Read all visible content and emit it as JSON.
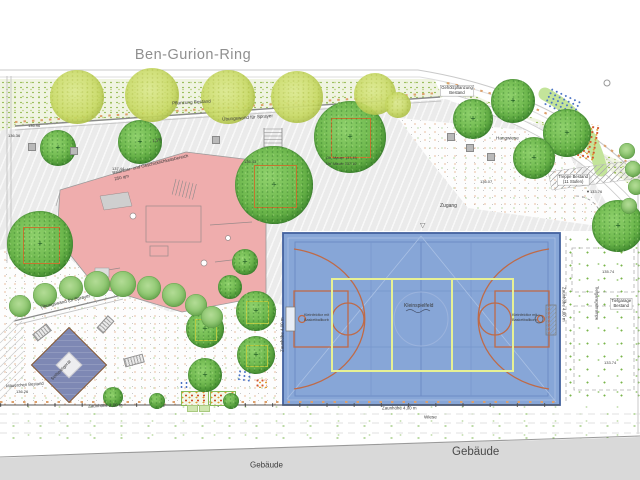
{
  "street_name": "Ben-Gurion-Ring",
  "building_label": "Gebäude",
  "colors": {
    "court_blue": "#87a6d7",
    "court_line_orange": "#bf6a47",
    "court_line_yellow": "#e7f193",
    "playground_pink": "#efadad",
    "equip_blue": "#7e88b4",
    "tree_green": "#67b247",
    "tree_light_green": "#c8da63",
    "building_gray": "#d9d9d9"
  },
  "labels": [
    {
      "t": "Pflanzung Bestand",
      "x": 172,
      "y": 101,
      "r": -3,
      "f": 4.6,
      "n": "planting-existing"
    },
    {
      "t": "Übungswand für Sprayer",
      "x": 222,
      "y": 117,
      "r": -4,
      "f": 4.6,
      "n": "sprayer-wall"
    },
    {
      "t": "Übungswand für Sprayer",
      "x": 40,
      "y": 305,
      "r": -13,
      "f": 4.6,
      "n": "sprayer-wall-2"
    },
    {
      "t": "Zugang",
      "x": 440,
      "y": 203,
      "r": 0,
      "f": 5,
      "n": "entrance"
    },
    {
      "t": "Hangwiese",
      "x": 496,
      "y": 136,
      "r": 0,
      "f": 4.6,
      "n": "slope-meadow"
    },
    {
      "t": "Wiese",
      "x": 424,
      "y": 415,
      "r": 0,
      "f": 4.6,
      "n": "meadow"
    },
    {
      "t": "Gebäude",
      "x": 250,
      "y": 461,
      "r": 0,
      "f": 8,
      "n": "building-small"
    },
    {
      "t": "Zaunhöhe 2,00 m",
      "x": 88,
      "y": 404,
      "r": -2,
      "f": 4.4,
      "n": "fence-2m"
    },
    {
      "t": "Zaunhöhe 4,00 m",
      "x": 382,
      "y": 406,
      "r": 0,
      "f": 4.4,
      "n": "fence-4m-bottom"
    },
    {
      "t": "Zaunhöhe 4,00 m",
      "x": 566,
      "y": 287,
      "r": 90,
      "f": 4.4,
      "n": "fence-4m-right"
    },
    {
      "t": "Zaunhöhe 4,00 m",
      "x": 280,
      "y": 352,
      "r": -90,
      "f": 4.4,
      "n": "fence-4m-left"
    },
    {
      "t": "Mäuerchen Bestand",
      "x": 6,
      "y": 384,
      "r": -4,
      "f": 4.2,
      "n": "wall-existing"
    },
    {
      "t": "Tiefgaragenrampe",
      "x": 599,
      "y": 286,
      "r": 90,
      "f": 4.2,
      "n": "garage-ramp"
    },
    {
      "t": "Seilspielgerät",
      "x": 50,
      "y": 378,
      "r": -45,
      "f": 4.4,
      "n": "rope-play"
    },
    {
      "t": "Kleinspielfeld",
      "x": 404,
      "y": 303,
      "r": 0,
      "f": 5,
      "n": "court-center"
    },
    {
      "t": "Kleinfeldtor mit",
      "x": 304,
      "y": 313,
      "r": 0,
      "f": 3.8,
      "n": "goal-left-1"
    },
    {
      "t": "Basketballkorb",
      "x": 304,
      "y": 318,
      "r": 0,
      "f": 3.8,
      "n": "goal-left-2"
    },
    {
      "t": "Kleinfeldtor mit",
      "x": 512,
      "y": 313,
      "r": 0,
      "f": 3.8,
      "n": "goal-right-1"
    },
    {
      "t": "Basketballkorb",
      "x": 512,
      "y": 318,
      "r": 0,
      "f": 3.8,
      "n": "goal-right-2"
    },
    {
      "t": "Balancier- und Geschicklichkeitsbereich",
      "x": 112,
      "y": 171,
      "r": -13,
      "f": 4.4,
      "n": "playground-title"
    },
    {
      "t": "250 qm",
      "x": 114,
      "y": 177,
      "r": -13,
      "f": 4.4,
      "n": "playground-area"
    },
    {
      "t": "Ob. Mauer 137.45",
      "x": 326,
      "y": 156,
      "r": 0,
      "f": 3.8,
      "n": "wall-top-elev"
    },
    {
      "t": "Un. Mauer 137.10",
      "x": 326,
      "y": 162,
      "r": 0,
      "f": 3.8,
      "n": "wall-bottom-elev"
    },
    {
      "t": "1,5%",
      "x": 152,
      "y": 139,
      "r": -10,
      "f": 4.2,
      "n": "slope-percent"
    },
    {
      "t": "136.96",
      "x": 28,
      "y": 124,
      "r": 0,
      "f": 4,
      "n": "elev"
    },
    {
      "t": "137.44",
      "x": 112,
      "y": 167,
      "r": 0,
      "f": 4,
      "n": "elev"
    },
    {
      "t": "136.43",
      "x": 244,
      "y": 160,
      "r": 0,
      "f": 4,
      "n": "elev"
    },
    {
      "t": "136.36",
      "x": 8,
      "y": 134,
      "r": 0,
      "f": 4,
      "n": "elev"
    },
    {
      "t": "136.26",
      "x": 16,
      "y": 390,
      "r": 0,
      "f": 4,
      "n": "elev"
    },
    {
      "t": "136.07",
      "x": 480,
      "y": 180,
      "r": 0,
      "f": 4,
      "n": "elev"
    },
    {
      "t": "135.74",
      "x": 602,
      "y": 270,
      "r": 0,
      "f": 4,
      "n": "elev"
    },
    {
      "t": "133.74",
      "x": 604,
      "y": 361,
      "r": 0,
      "f": 4,
      "n": "elev"
    },
    {
      "t": "▼133.76",
      "x": 586,
      "y": 190,
      "r": 0,
      "f": 4,
      "n": "elev"
    },
    {
      "t": "▽",
      "x": 420,
      "y": 222,
      "r": 0,
      "f": 7,
      "c": "#666",
      "n": "benchmark"
    }
  ],
  "label_boxes": [
    {
      "l1": "Gehölzpflanzung",
      "l2": "Bestand",
      "x": 440,
      "y": 85,
      "n": "shrub-planting-existing"
    },
    {
      "l1": "Treppe Bestand",
      "l2": "(11 Stufen)",
      "x": 557,
      "y": 174,
      "n": "stairs-existing"
    },
    {
      "l1": "Tiefgarage",
      "l2": "Bestand",
      "x": 610,
      "y": 298,
      "n": "garage-existing"
    }
  ],
  "trees": {
    "dark": [
      [
        58,
        148,
        18
      ],
      [
        140,
        142,
        22
      ],
      [
        274,
        185,
        39,
        "o"
      ],
      [
        350,
        137,
        36,
        "o"
      ],
      [
        40,
        244,
        33,
        "o"
      ],
      [
        473,
        119,
        20
      ],
      [
        513,
        101,
        22
      ],
      [
        567,
        133,
        24
      ],
      [
        534,
        158,
        21
      ],
      [
        618,
        226,
        26
      ],
      [
        205,
        329,
        19,
        "y"
      ],
      [
        256,
        311,
        20,
        "y"
      ],
      [
        256,
        355,
        19,
        "y"
      ],
      [
        205,
        375,
        17
      ],
      [
        245,
        262,
        13
      ],
      [
        230,
        287,
        12
      ],
      [
        113,
        397,
        10
      ],
      [
        157,
        401,
        8
      ],
      [
        231,
        401,
        8
      ]
    ],
    "light": [
      [
        77,
        97,
        27
      ],
      [
        152,
        95,
        27
      ],
      [
        228,
        97,
        27
      ],
      [
        297,
        97,
        26
      ],
      [
        375,
        94,
        21
      ],
      [
        398,
        105,
        13
      ]
    ],
    "bushes": [
      [
        20,
        306,
        11
      ],
      [
        45,
        295,
        12
      ],
      [
        71,
        288,
        12
      ],
      [
        97,
        284,
        13
      ],
      [
        123,
        284,
        13
      ],
      [
        149,
        288,
        12
      ],
      [
        174,
        295,
        12
      ],
      [
        196,
        305,
        11
      ],
      [
        212,
        317,
        11
      ],
      [
        627,
        151,
        8
      ],
      [
        633,
        169,
        8
      ],
      [
        636,
        187,
        8
      ],
      [
        629,
        206,
        8
      ]
    ]
  },
  "cubes": [
    [
      28,
      143
    ],
    [
      70,
      147
    ],
    [
      212,
      136
    ],
    [
      447,
      133
    ],
    [
      466,
      144
    ],
    [
      487,
      153
    ]
  ],
  "benches": [
    [
      33,
      328,
      16,
      -38
    ],
    [
      124,
      356,
      18,
      -15
    ],
    [
      97,
      320,
      15,
      -48
    ]
  ]
}
